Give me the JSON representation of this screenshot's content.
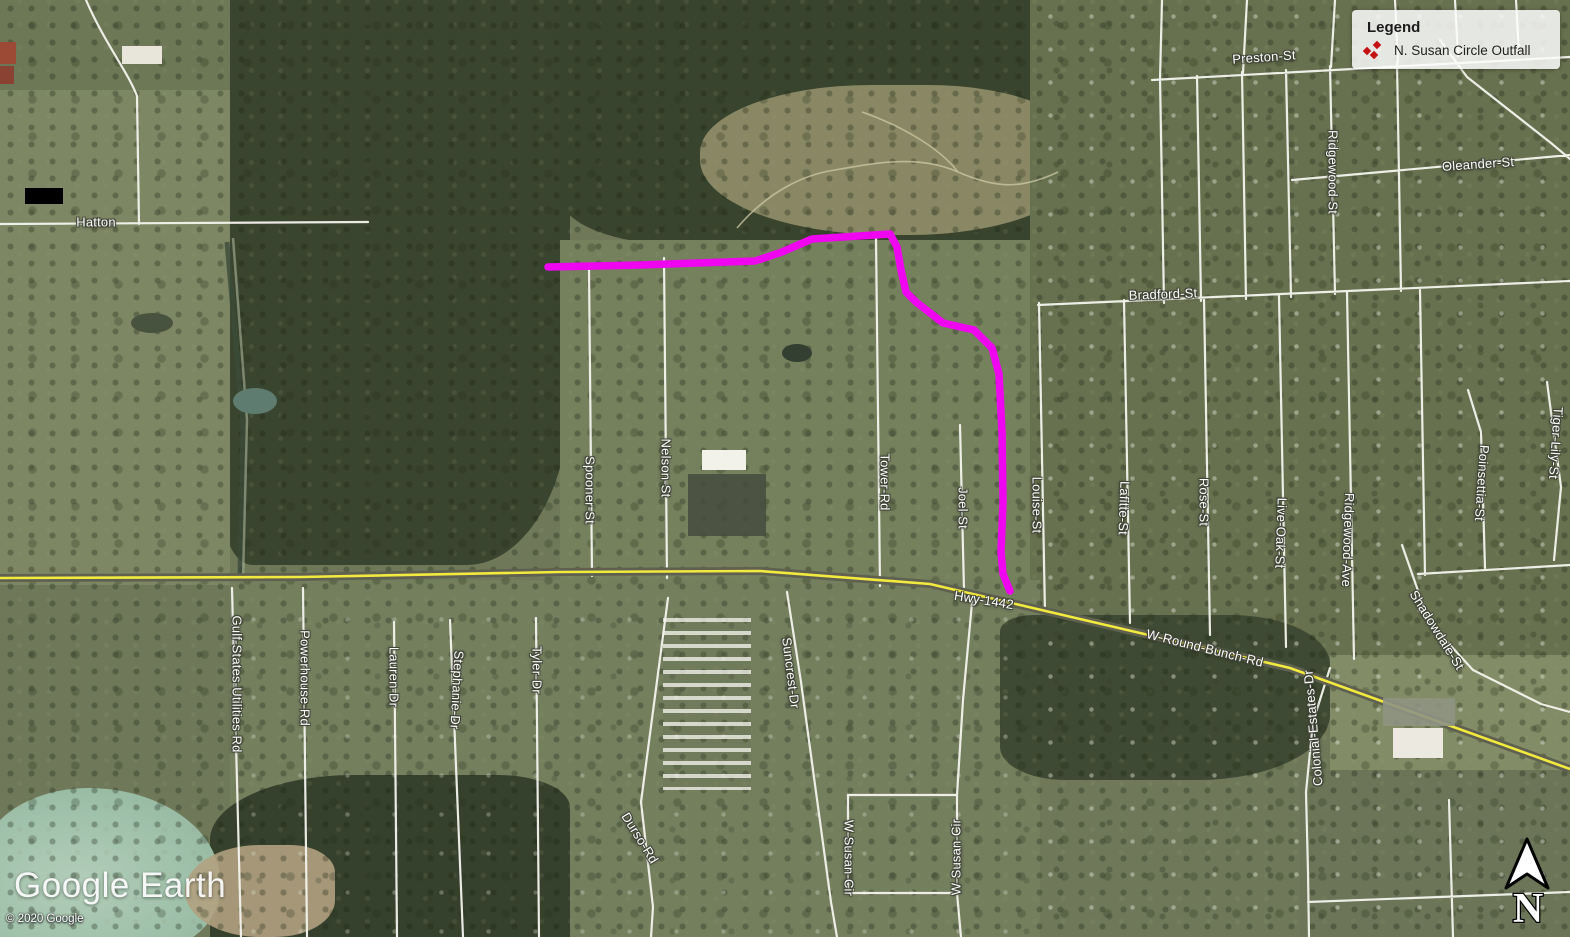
{
  "app": {
    "name": "Google Earth"
  },
  "legend": {
    "title": "Legend",
    "items": [
      {
        "icon": "outfall-cluster-icon",
        "icon_color": "#c41212",
        "label": "N. Susan Circle Outfall"
      }
    ]
  },
  "overlay": {
    "outfall_path_name": "N. Susan Circle Outfall",
    "outfall_path_color": "#f005f0",
    "highway_color": "#f2ea3f"
  },
  "compass": {
    "north_label": "N"
  },
  "watermark": {
    "logo": "Google Earth",
    "copyright": "© 2020 Google"
  },
  "map": {
    "imagery": "satellite",
    "labels": {
      "hatton": "Hatton",
      "preston": "Preston-St",
      "oleander": "Oleander-St",
      "ridgewood_st": "Ridgewood-St",
      "bradford": "Bradford-St",
      "spooner": "Spooner-St",
      "nelson": "Nelson-St",
      "tower": "Tower-Rd",
      "joel": "Joel-St",
      "louise": "Louise-St",
      "lafitte": "Lafitte-St",
      "rose": "Rose-St",
      "live_oak": "Live-Oak-St",
      "ridgewood_ave": "Ridgewood-Ave",
      "tiger_lily": "Tiger-Lily-St",
      "poinsettia": "Poinsettia-St",
      "shadowdale": "Shadowdale-St",
      "hwy_1442": "Hwy-1442",
      "round_bunch": "W-Round-Bunch-Rd",
      "gulf_states": "Gulf-States-Utilities-Rd",
      "powerhouse": "Powerhouse-Rd",
      "lauren": "Lauren-Dr",
      "stephanie": "Stephanie-Dr",
      "tyler": "Tyler-Dr",
      "durso": "Durso-Rd",
      "suncrest": "Suncrest-Dr",
      "w_susan_left": "W-Susan-Cir",
      "w_susan_right": "W-Susan-Cir",
      "colonial": "Colonial-Estates-Dr"
    }
  }
}
